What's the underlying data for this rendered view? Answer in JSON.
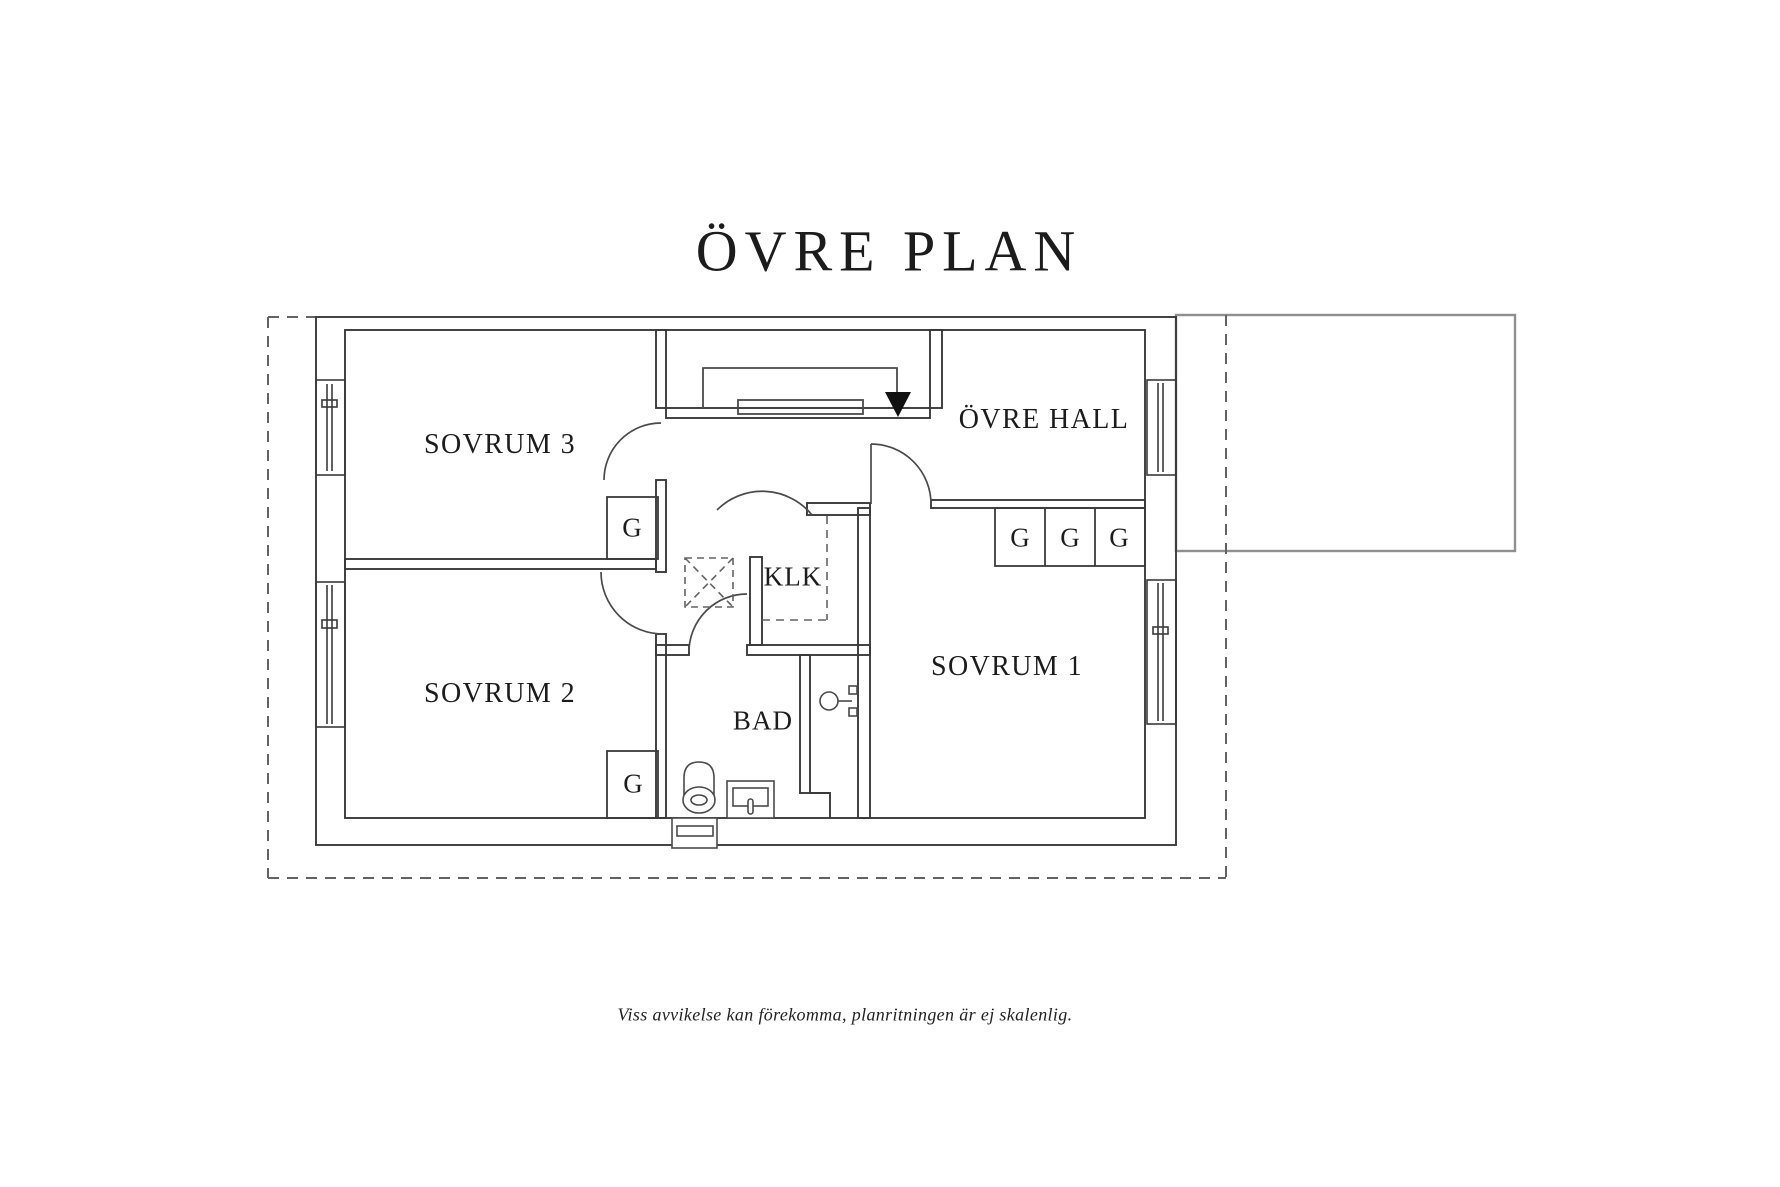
{
  "title": "ÖVRE PLAN",
  "rooms": {
    "sovrum3": {
      "label": "SOVRUM 3"
    },
    "sovrum2": {
      "label": "SOVRUM 2"
    },
    "sovrum1": {
      "label": "SOVRUM 1"
    },
    "ovre_hall": {
      "label": "ÖVRE HALL"
    },
    "klk": {
      "label": "KLK"
    },
    "bad": {
      "label": "BAD"
    }
  },
  "wardrobe": {
    "label": "G"
  },
  "footer": {
    "disclaimer": "Viss avvikelse kan förekomma, planritningen är ej skalenlig."
  },
  "icons": {
    "stairs_arrow": "stairs-down-arrow",
    "toilet": "toilet",
    "sink": "sink",
    "skylight": "skylight-hatch",
    "window": "window"
  },
  "colors": {
    "wall_line": "#3a3a3a",
    "detail_line": "#4a4a4a",
    "dashed_line": "#636363",
    "garage_outline": "#8f8f8f",
    "arrow_fill": "#111111",
    "text": "#1c1c1c"
  }
}
